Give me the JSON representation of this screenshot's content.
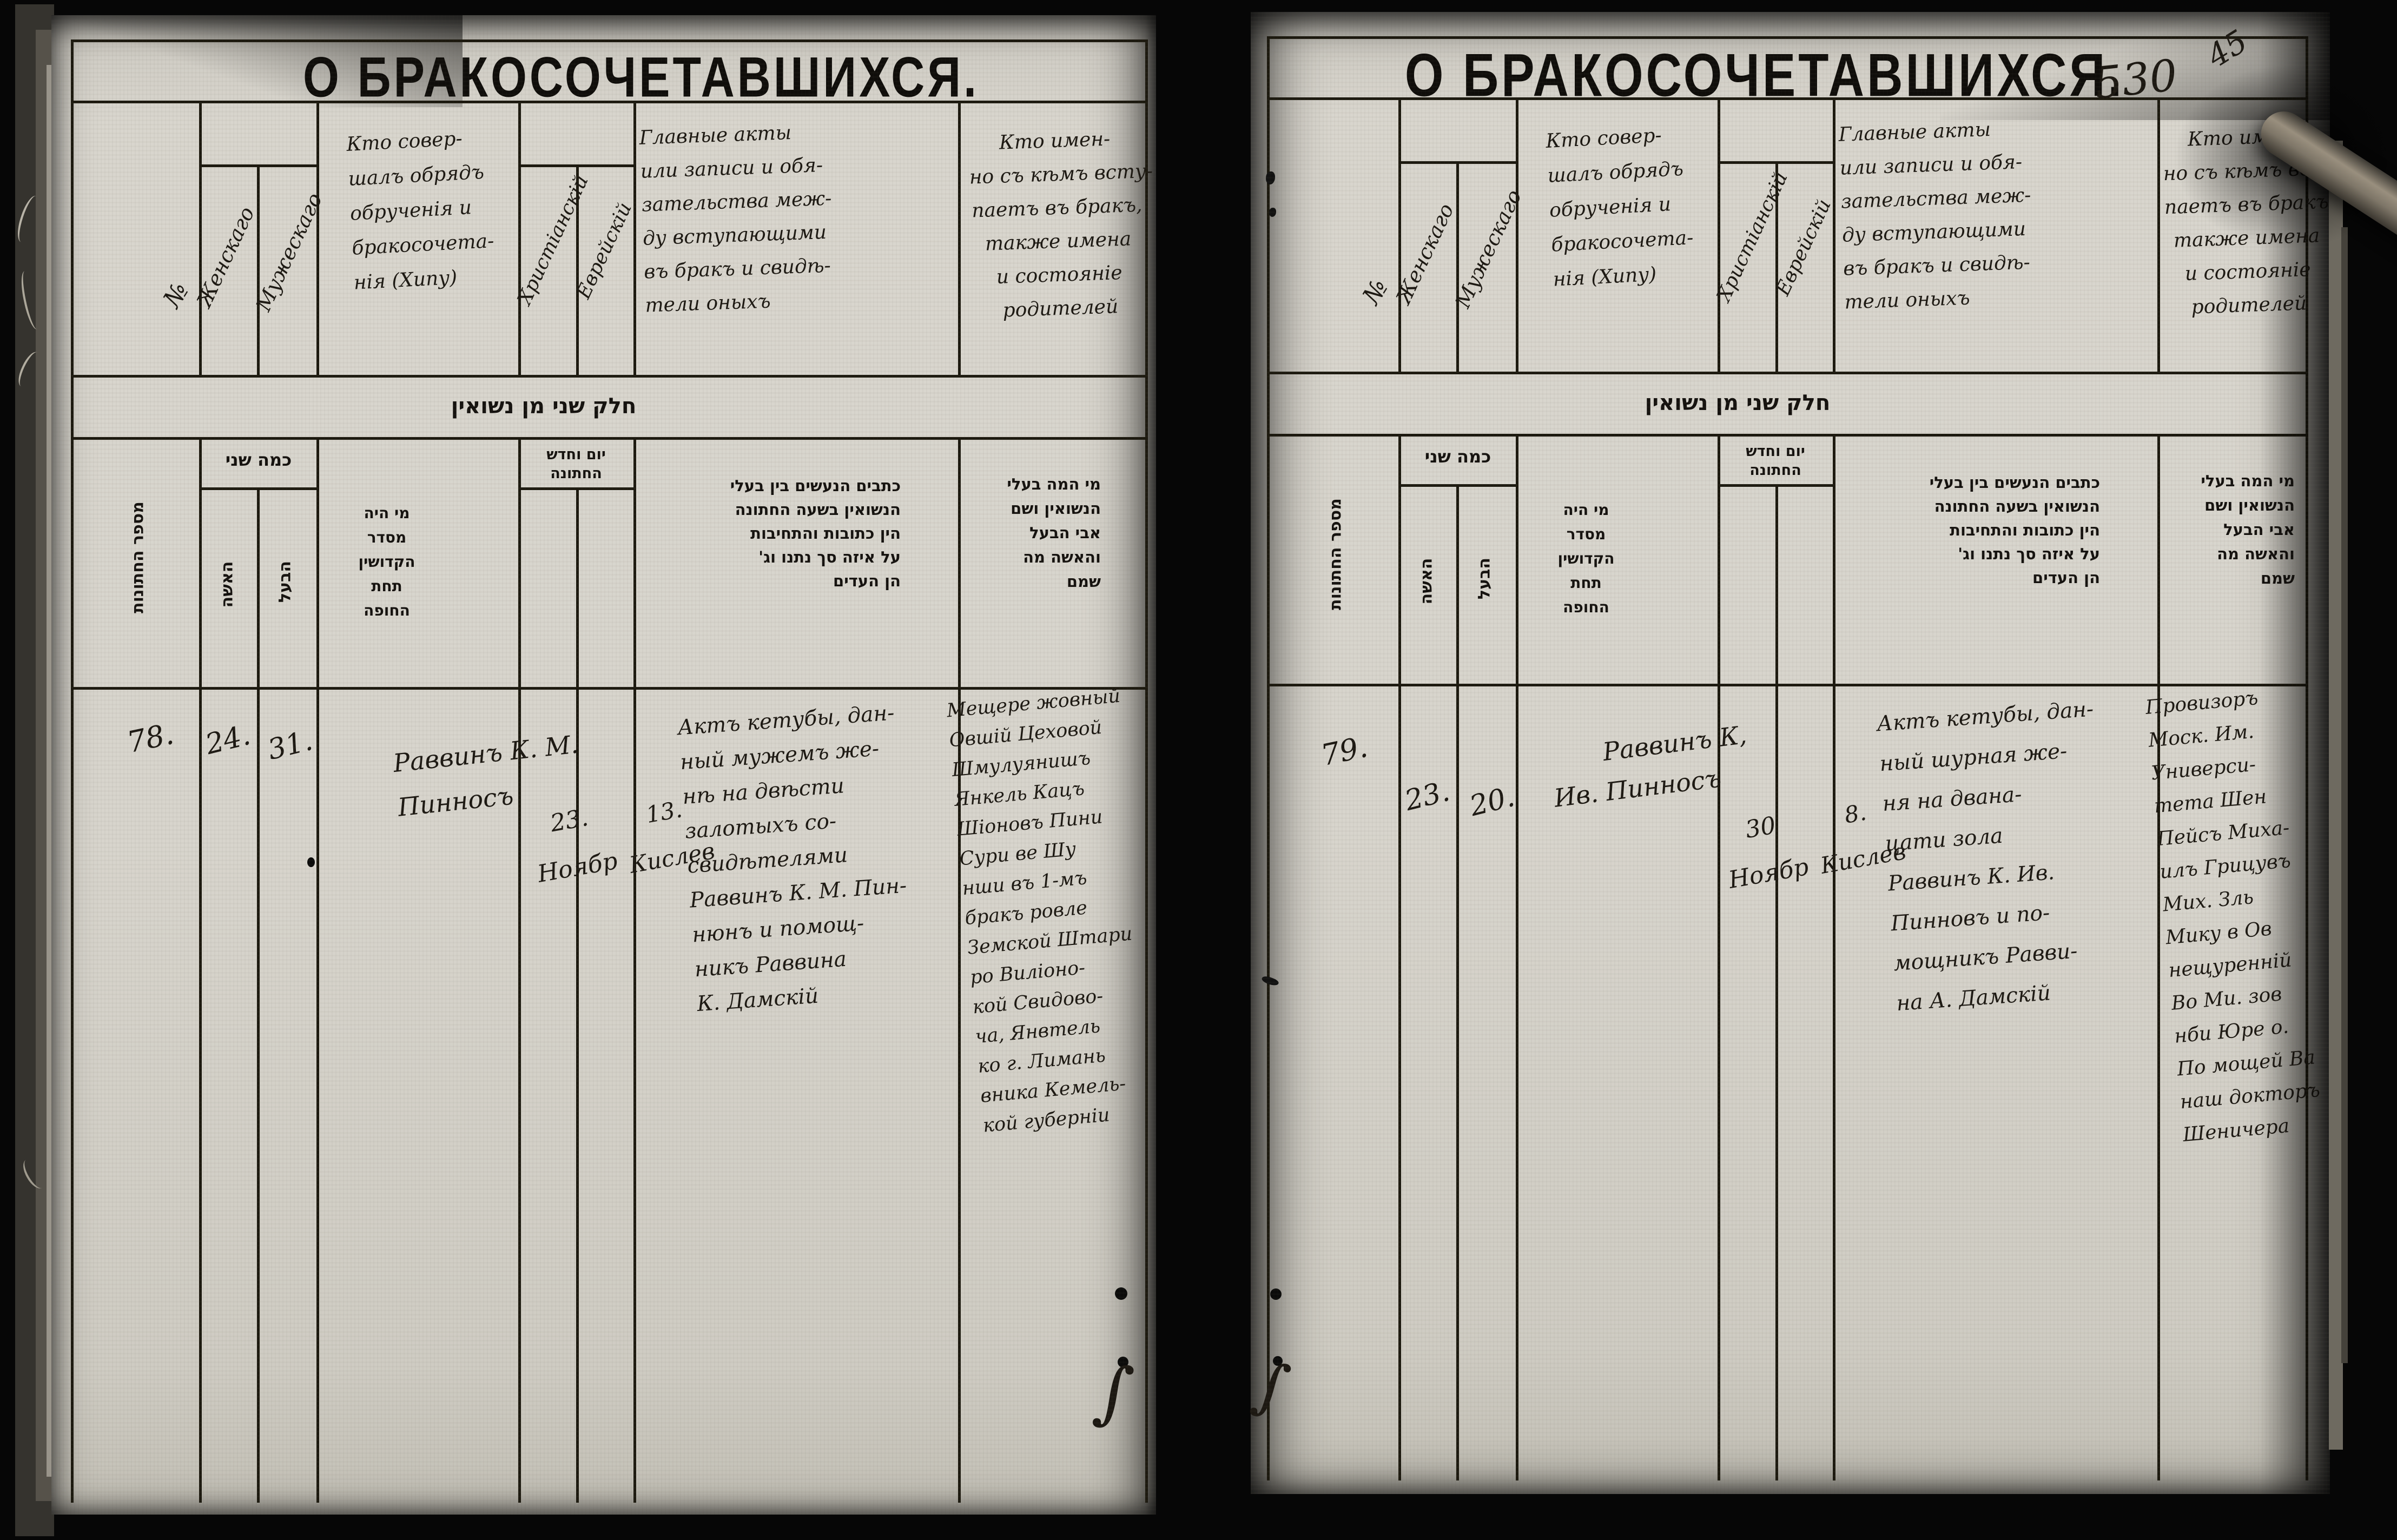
{
  "annotations": {
    "page_number": "530",
    "folio_number": "45"
  },
  "titles": {
    "left": "О БРАКОСОЧЕТАВШИХСЯ.",
    "right": "О БРАКОСОЧЕТАВШИХСЯ."
  },
  "columns_ru": {
    "number": "№",
    "age_female": "Женскаго",
    "age_male": "Мужескаго",
    "officiant_lines": [
      "Кто совер-",
      "шалъ обрядъ",
      "обрученія и",
      "бракосочета-",
      "нія (Хипу)"
    ],
    "date_christian": "Христіанскій",
    "date_jewish": "Еврейскій",
    "acts_lines": [
      "Главные акты",
      "или записи и обя-",
      "зательства меж-",
      "ду вступающими",
      "въ бракъ и свидѣ-",
      "тели оныхъ"
    ],
    "who_lines": [
      "Кто имен-",
      "но съ кѣмъ всту-",
      "паетъ въ бракъ,",
      "также имена",
      "и состояніе",
      "родителей"
    ]
  },
  "columns_he": {
    "band": "חלק שני מן נשואין",
    "number": "מספר החתונות",
    "ages_header": "כמה שני",
    "age_female": "האשה",
    "age_male": "הבעל",
    "officiant_lines": [
      "מי היה",
      "מסדר",
      "הקדושין",
      "תחת",
      "החופה"
    ],
    "date_header_lines": [
      "יום וחדש",
      "החתונה"
    ],
    "acts_lines": [
      "כתבים הנעשים בין בעלי",
      "הנשואין בשעה החתונה",
      "הין כתובות והתחיבות",
      "על איזה סך נתנו וג'",
      "הן העדים"
    ],
    "who_lines": [
      "מי המה בעלי",
      "הנשואין ושם",
      "אבי הבעל",
      "והאשה מה",
      "שמם"
    ]
  },
  "entries": {
    "left": {
      "number": "78.",
      "age_female": "24.",
      "age_male": "31.",
      "officiant_lines": [
        "Раввинъ К. М.",
        "Пинносъ"
      ],
      "date_christian_lines": [
        "23.",
        "Ноябр"
      ],
      "date_jewish_lines": [
        "13.",
        "Кислев"
      ],
      "acts_lines": [
        "Актъ кетубы, дан-",
        "ный мужемъ же-",
        "нѣ на двѣсти",
        "залотыхъ со-",
        "свидѣтелями",
        "Раввинъ К. М. Пин-",
        "нюнъ и помощ-",
        "никъ Раввина",
        "К. Дамскій"
      ],
      "couple_lines": [
        "Мещере жовный",
        "Овшій Цеховой",
        "Шмулуянишъ",
        "Янкель Кацъ",
        "Шіоновъ Пини",
        "Сури ве Шу",
        "нши въ 1-мъ",
        "бракъ ровле",
        "Земской Штари",
        "ро Виліоно-",
        "кой Свидово-",
        "ча, Янвтель",
        "ко г. Лимань",
        "вника Кемель-",
        "кой губерніи"
      ]
    },
    "right": {
      "number": "79.",
      "age_female": "23.",
      "age_male": "20.",
      "officiant_lines": [
        "Раввинъ К,",
        "Ив. Пинносъ"
      ],
      "date_christian_lines": [
        "30",
        "Ноябр"
      ],
      "date_jewish_lines": [
        "8.",
        "Кислев"
      ],
      "acts_lines": [
        "Актъ кетубы, дан-",
        "ный шурная же-",
        "ня на двана-",
        "цати зола",
        "Раввинъ К. Ив.",
        "Пинновъ и по-",
        "мощникъ Равви-",
        "на А. Дамскій"
      ],
      "couple_lines": [
        "Провизоръ",
        "Моск. Им.",
        "Универси-",
        "тета Шен",
        "Пейсъ Миха-",
        "илъ Грицувъ",
        "Мих. Зль",
        "Мику в Ов",
        "нещуренній",
        "Во Ми. зов",
        "нби Юре о.",
        "По мощей Ва",
        "наш докторъ",
        "Шеничера"
      ]
    }
  }
}
